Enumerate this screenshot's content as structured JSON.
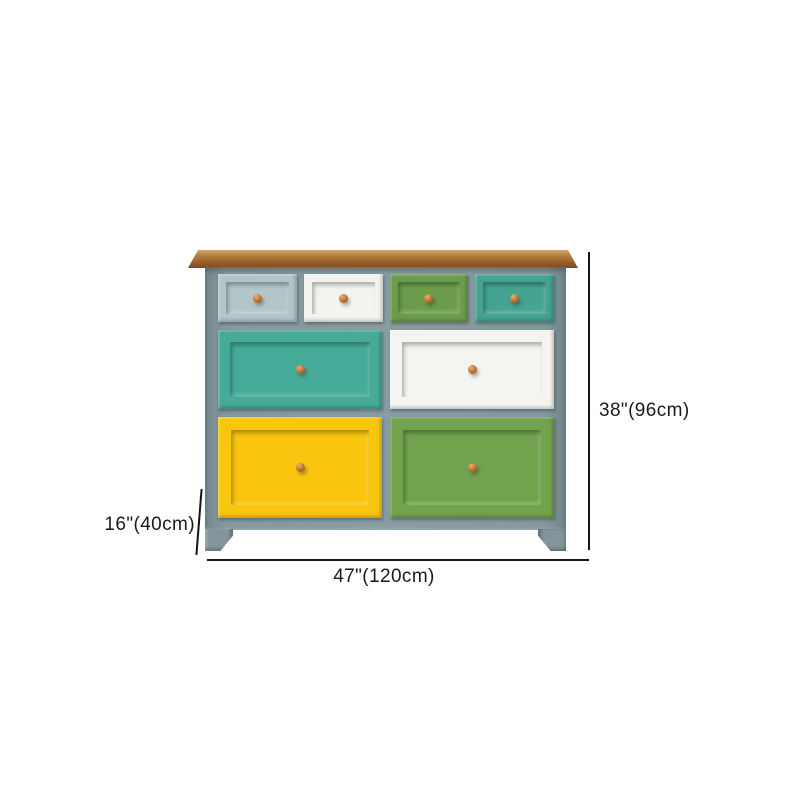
{
  "page": {
    "background": "#ffffff"
  },
  "diagram": {
    "type": "product-dimension-diagram",
    "subject": "eight-drawer multicolor chest of drawers with wood top",
    "dimensions": {
      "height": "38\"(96cm)",
      "depth": "16\"(40cm)",
      "width": "47\"(120cm)"
    },
    "palette": {
      "wood_top": "#a87434",
      "frame": "#82959b",
      "knob": "#b5692f",
      "dimension_line": "#141414",
      "label_text": "#1a1a1a"
    },
    "drawers": [
      {
        "name": "top-row-drawer-1",
        "color_name": "blue-gray",
        "color": "#b3c5ca"
      },
      {
        "name": "top-row-drawer-2",
        "color_name": "white",
        "color": "#f3f3ef"
      },
      {
        "name": "top-row-drawer-3",
        "color_name": "green",
        "color": "#6b9c4a"
      },
      {
        "name": "top-row-drawer-4",
        "color_name": "teal",
        "color": "#44a391"
      },
      {
        "name": "middle-row-drawer-1",
        "color_name": "teal",
        "color": "#46aa98"
      },
      {
        "name": "middle-row-drawer-2",
        "color_name": "white",
        "color": "#f4f4f0"
      },
      {
        "name": "bottom-row-drawer-1",
        "color_name": "yellow",
        "color": "#f9c50f"
      },
      {
        "name": "bottom-row-drawer-2",
        "color_name": "green",
        "color": "#71a24e"
      }
    ]
  }
}
